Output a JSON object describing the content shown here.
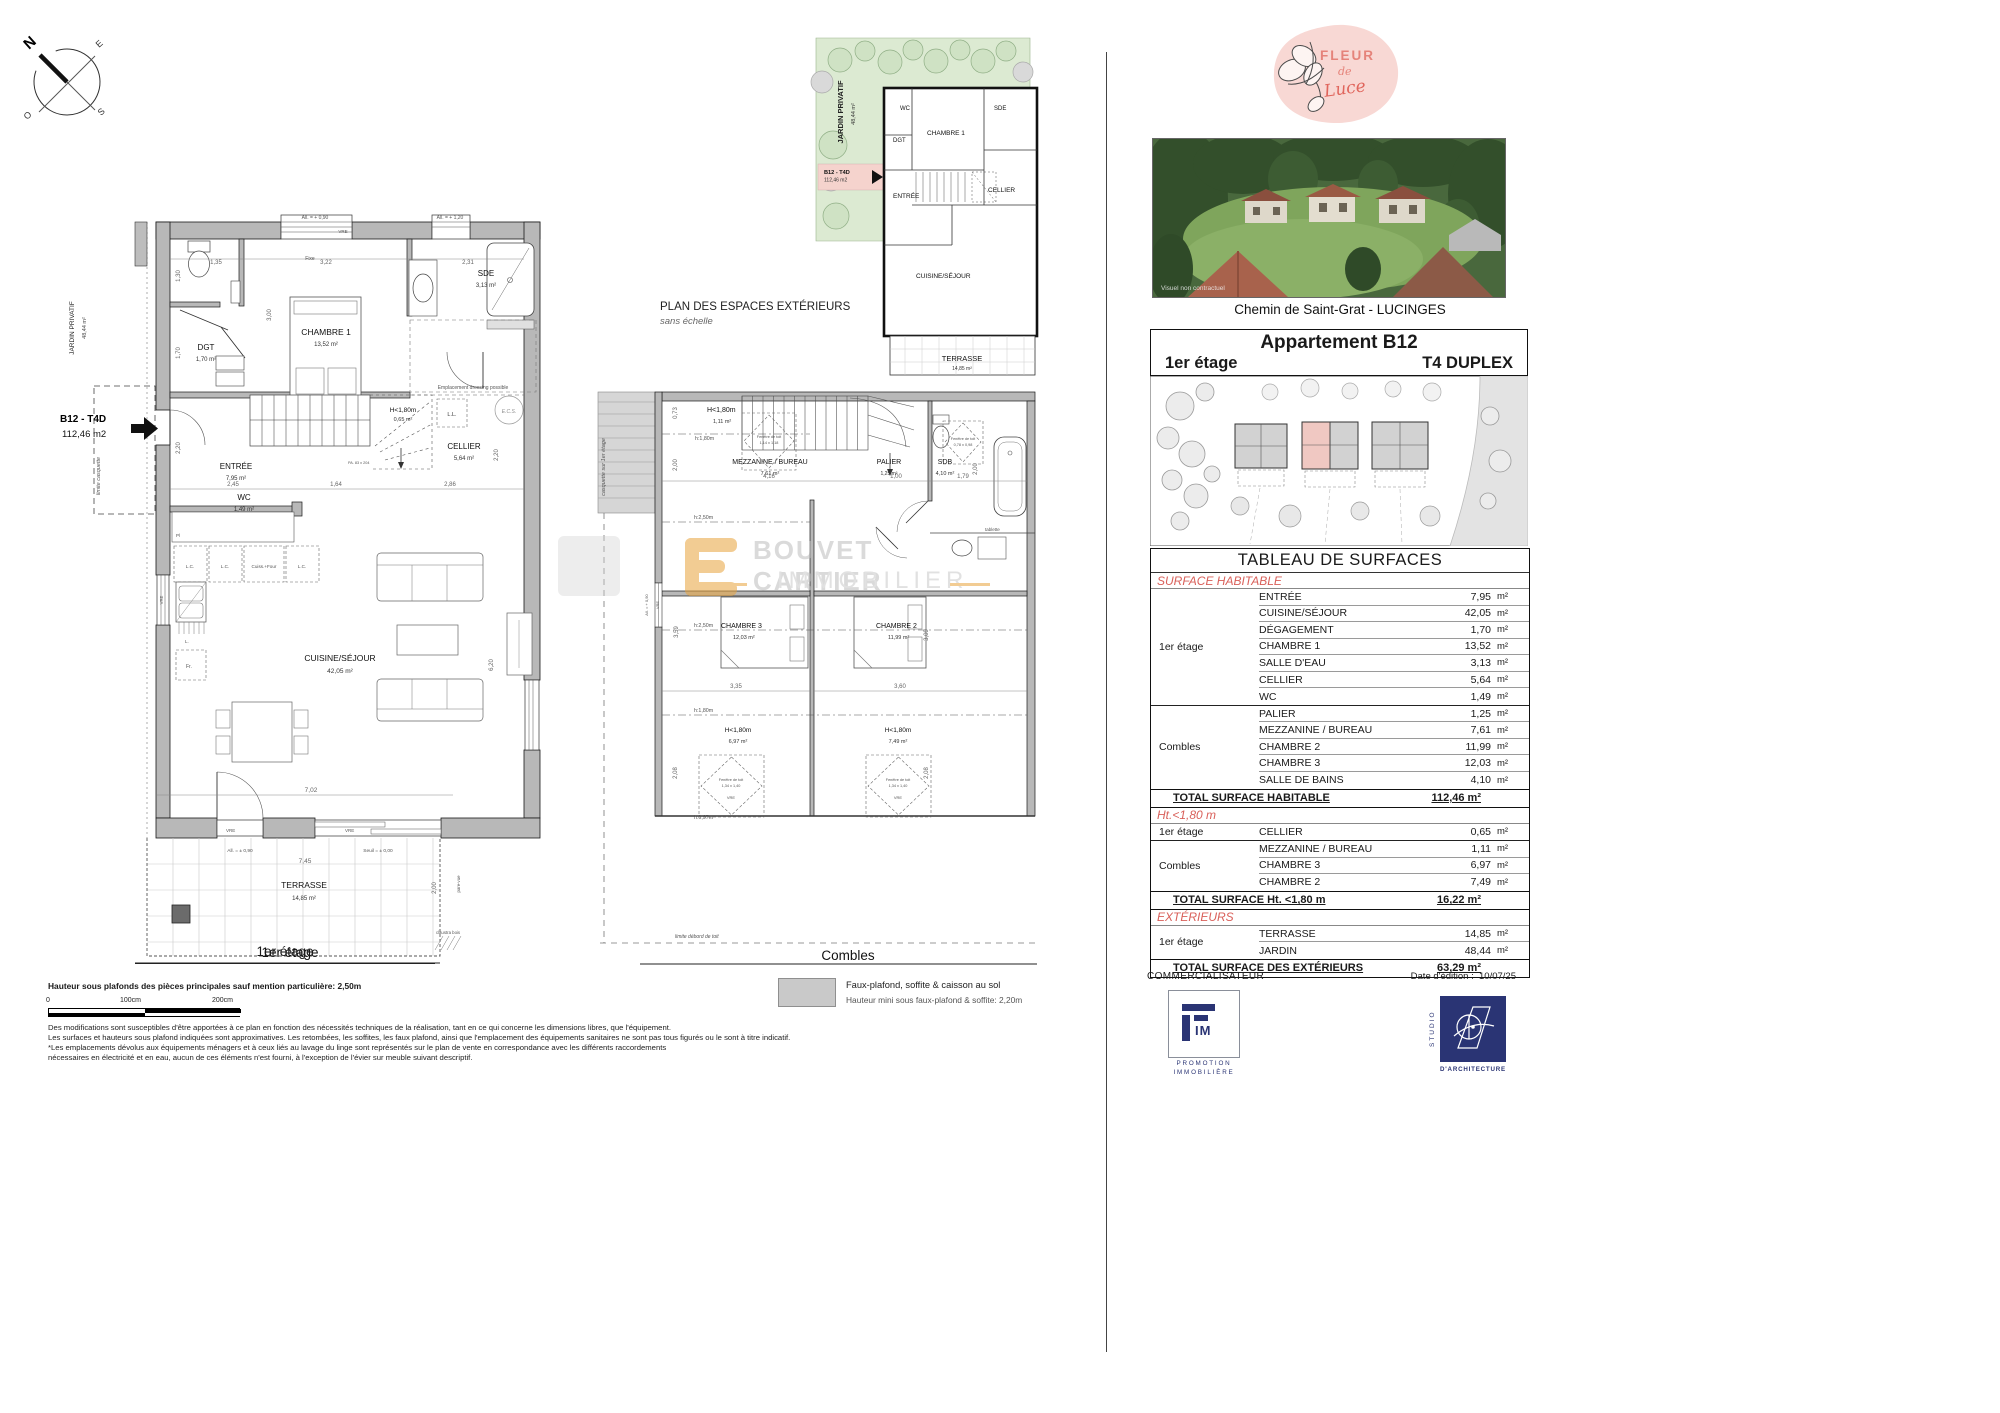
{
  "compass": {
    "n": "N",
    "e": "E",
    "s": "S",
    "o": "O"
  },
  "p1": {
    "title": "1er étage",
    "marker_code": "B12 - T4D",
    "marker_area": "112,46 m2",
    "jardin": "JARDIN PRIVATIF",
    "jardin_area": "48,44 m²",
    "limite_casquette": "limite casquette",
    "rooms": {
      "wc": {
        "n": "WC",
        "a": "1,49 m²"
      },
      "dgt": {
        "n": "DGT",
        "a": "1,70 m²"
      },
      "ch1": {
        "n": "CHAMBRE 1",
        "a": "13,52 m²"
      },
      "sde": {
        "n": "SDE",
        "a": "3,13 m²"
      },
      "cellier": {
        "n": "CELLIER",
        "a": "5,64 m²"
      },
      "entree": {
        "n": "ENTRÉE",
        "a": "7,95 m²"
      },
      "cuisine": {
        "n": "CUISINE/SÉJOUR",
        "a": "42,05 m²"
      },
      "terrasse": {
        "n": "TERRASSE",
        "a": "14,85 m²"
      }
    },
    "low": {
      "n": "H<1,80m",
      "a": "0,65 m²"
    },
    "ann": {
      "all090": "All. = + 0,90",
      "all120": "All. = + 1,20",
      "allpm090": "All. = ± 0,90",
      "seuil": "Seuil = ± 0,00",
      "vre": "VRE",
      "fixe": "Fixe",
      "dressing": "Emplacement dressing possible",
      "ll": "L.L.",
      "ecs": "E.C.S.",
      "lc": "L.C.",
      "cuiss": "Cuiss.+Four",
      "pl": "Pl",
      "fr": "Fr.",
      "l": "L.",
      "claustra": "claustra bois",
      "parevue": "pare-vue",
      "pa": "PA. 83 x 204"
    },
    "dims": {
      "d135": "1,35",
      "d322": "3,22",
      "d231": "2,31",
      "d130": "1,30",
      "d300": "3,00",
      "d170": "1,70",
      "d220a": "2,20",
      "d245": "2,45",
      "d164": "1,64",
      "d286": "2,86",
      "d220b": "2,20",
      "d620": "6,20",
      "d702": "7,02",
      "d745": "7,45",
      "d200": "2,00"
    }
  },
  "pext": {
    "title": "PLAN DES ESPACES EXTÉRIEURS",
    "subtitle": "sans échelle",
    "jardin": "JARDIN PRIVATIF",
    "jardin_area": "48,44 m²",
    "marker_code": "B12 - T4D",
    "marker_area": "112,46 m2",
    "wc": "WC",
    "dgt": "DGT",
    "ch1": "CHAMBRE 1",
    "sde": "SDE",
    "entree": "ENTRÉE",
    "cellier": "CELLIER",
    "cuisine": "CUISINE/SÉJOUR",
    "terrasse": "TERRASSE",
    "terrasse_area": "14,85 m²"
  },
  "pc": {
    "title": "Combles",
    "casquette": "casquette sur 1er étage",
    "limite": "limite débord de toit",
    "rooms": {
      "mez": {
        "n": "MEZZANINE / BUREAU",
        "a": "7,61 m²"
      },
      "palier": {
        "n": "PALIER",
        "a": "1,25 m²"
      },
      "sdb": {
        "n": "SDB",
        "a": "4,10 m²"
      },
      "ch3": {
        "n": "CHAMBRE 3",
        "a": "12,03 m²"
      },
      "ch2": {
        "n": "CHAMBRE 2",
        "a": "11,99 m²"
      }
    },
    "low1": {
      "n": "H<1,80m",
      "a": "1,11 m²"
    },
    "low3": {
      "n": "H<1,80m",
      "a": "6,97 m²"
    },
    "low2": {
      "n": "H<1,80m",
      "a": "7,49 m²"
    },
    "ann": {
      "h180": "h:1,80m",
      "h250": "h:2,50m",
      "h097": "h:0,97m",
      "ft": "Fenêtre de toit",
      "ft1": "1,14 x 1,18",
      "ft2": "0,78 x 0,98",
      "ft3": "1,34 x 1,40",
      "vre": "VRE",
      "tablette": "tablette",
      "all090": "All. = + 0,90"
    },
    "dims": {
      "d073": "0,73",
      "d416": "4,16",
      "d100": "1,00",
      "d179": "1,79",
      "d200a": "2,00",
      "d200b": "2,00",
      "d335": "3,35",
      "d360": "3,60",
      "d359": "3,59",
      "d309": "3,09",
      "d208a": "2,08",
      "d208b": "2,08"
    }
  },
  "watermark": {
    "line1": "BOUVET CARTIER",
    "line2": "IMMOBILIER"
  },
  "brand": {
    "word1": "FLEUR",
    "word2": "de",
    "word3": "Luce"
  },
  "photo": {
    "caption": "Visuel non contractuel"
  },
  "panel": {
    "address": "Chemin de Saint-Grat - LUCINGES",
    "apartment": "Appartement B12",
    "floor": "1er étage",
    "type": "T4 DUPLEX"
  },
  "table": {
    "title": "TABLEAU DE SURFACES",
    "unit": "m²",
    "s1": {
      "header": "SURFACE HABITABLE",
      "g1_floor": "1er étage",
      "g1": [
        [
          "ENTRÉE",
          "7,95"
        ],
        [
          "CUISINE/SÉJOUR",
          "42,05"
        ],
        [
          "DÉGAGEMENT",
          "1,70"
        ],
        [
          "CHAMBRE 1",
          "13,52"
        ],
        [
          "SALLE D'EAU",
          "3,13"
        ],
        [
          "CELLIER",
          "5,64"
        ],
        [
          "WC",
          "1,49"
        ]
      ],
      "g2_floor": "Combles",
      "g2": [
        [
          "PALIER",
          "1,25"
        ],
        [
          "MEZZANINE / BUREAU",
          "7,61"
        ],
        [
          "CHAMBRE 2",
          "11,99"
        ],
        [
          "CHAMBRE 3",
          "12,03"
        ],
        [
          "SALLE DE BAINS",
          "4,10"
        ]
      ],
      "total_label": "TOTAL SURFACE HABITABLE",
      "total_value": "112,46 m²"
    },
    "s2": {
      "header": "Ht.<1,80 m",
      "g1_floor": "1er étage",
      "g1": [
        [
          "CELLIER",
          "0,65"
        ]
      ],
      "g2_floor": "Combles",
      "g2": [
        [
          "MEZZANINE / BUREAU",
          "1,11"
        ],
        [
          "CHAMBRE 3",
          "6,97"
        ],
        [
          "CHAMBRE 2",
          "7,49"
        ]
      ],
      "total_label": "TOTAL SURFACE Ht. <1,80 m",
      "total_value": "16,22 m²"
    },
    "s3": {
      "header": "EXTÉRIEURS",
      "g1_floor": "1er étage",
      "g1": [
        [
          "TERRASSE",
          "14,85"
        ],
        [
          "JARDIN",
          "48,44"
        ]
      ],
      "total_label": "TOTAL SURFACE DES EXTÉRIEURS",
      "total_value": "63,29 m²"
    }
  },
  "footer": {
    "commercialisateur": "COMMERCIALISATEUR",
    "date_label": "Date d'édition :",
    "date_value": "10/07/25",
    "fim_im": "IM",
    "fim_line1": "PROMOTION",
    "fim_line2": "IMMOBILIÈRE",
    "studio_vertical": "STUDIO",
    "studio_sub": "D'ARCHITECTURE"
  },
  "bottom": {
    "height_note": "Hauteur sous plafonds des pièces principales sauf mention particulière: 2,50m",
    "scale0": "0",
    "scale100": "100cm",
    "scale200": "200cm",
    "legend1": "Faux-plafond, soffite & caisson au sol",
    "legend2": "Hauteur mini sous faux-plafond & soffite: 2,20m",
    "disc1": "Des modifications sont susceptibles d'être apportées à ce plan en fonction des nécessités techniques de la réalisation, tant en ce qui concerne les dimensions libres, que l'équipement.",
    "disc2": "Les surfaces et hauteurs sous plafond indiquées sont approximatives. Les retombées, les soffites, les faux plafond, ainsi que l'emplacement des équipements sanitaires ne sont pas tous figurés ou le sont à titre indicatif.",
    "disc3": "*Les emplacements dévolus aux équipements ménagers et à ceux liés au lavage du linge sont représentés sur le plan de vente en correspondance avec les différents raccordements",
    "disc4": "nécessaires en électricité et en eau, aucun de ces éléments n'est fourni, à l'exception de l'évier sur meuble suivant descriptif."
  }
}
